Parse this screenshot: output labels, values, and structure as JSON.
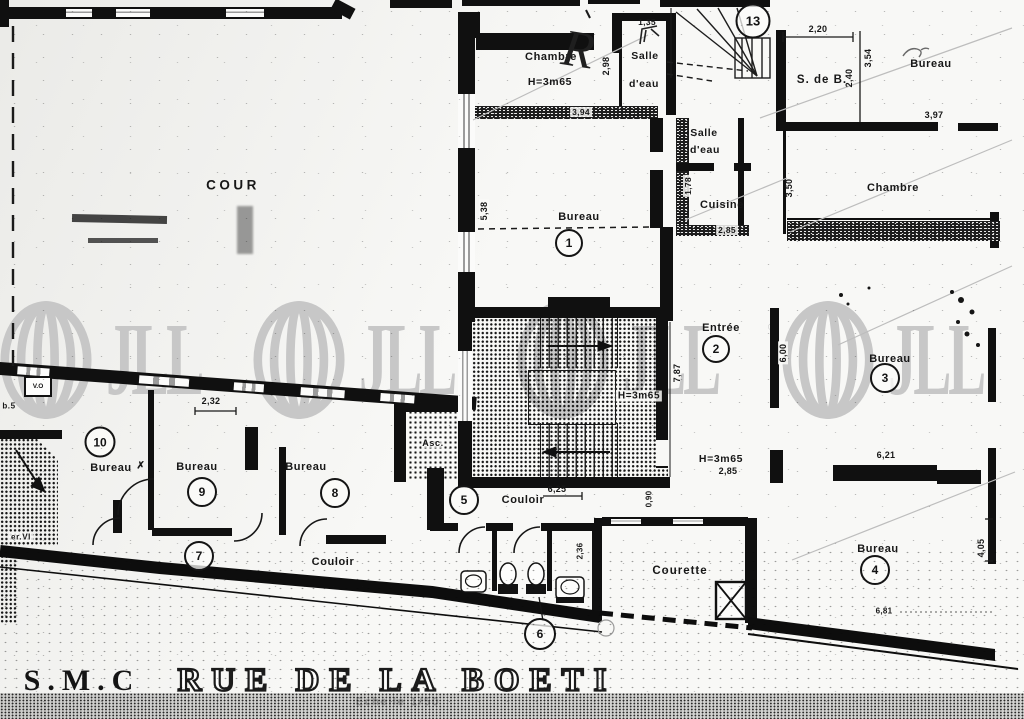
{
  "watermark": {
    "brand": "JLL",
    "registered": "®",
    "color": "#c7c7c7"
  },
  "title_block": {
    "company": "S.M.C",
    "street": "RUE DE LA BOETI",
    "scale_note": "Echelle 1/50"
  },
  "areas": {
    "cour": "COUR",
    "courette": "Courette",
    "couloir_west": "Couloir",
    "couloir_center": "Couloir",
    "cuisine": "Cuisine",
    "salle_eau_upper_1": "Salle",
    "salle_eau_upper_2": "d'eau",
    "salle_eau_mid_1": "Salle",
    "salle_eau_mid_2": "d'eau",
    "s_de_b": "S. de B.",
    "chambre_upper": "Chambre",
    "chambre_east": "Chambre",
    "bureau_ne": "Bureau",
    "asc": "Asc."
  },
  "rooms": {
    "r1": {
      "label": "Bureau",
      "num": "1"
    },
    "r2": {
      "label": "Entrée",
      "num": "2"
    },
    "r3": {
      "label": "Bureau",
      "num": "3"
    },
    "r4": {
      "label": "Bureau",
      "num": "4"
    },
    "r5": {
      "num": "5"
    },
    "r6": {
      "num": "6"
    },
    "r7": {
      "num": "7"
    },
    "r8": {
      "label": "Bureau",
      "num": "8"
    },
    "r9": {
      "label": "Bureau",
      "num": "9"
    },
    "r10": {
      "label": "Bureau",
      "num": "10",
      "mark": "✗"
    },
    "r13": {
      "num": "13"
    }
  },
  "heights": {
    "chambre": "H=3m65",
    "stairwell": "H=3m65",
    "east_wing": "H=3m65",
    "east_wing_sub": "2,85"
  },
  "dims": {
    "d135": "1,35",
    "d298": "2,98",
    "d394": "3,94",
    "d220": "2,20",
    "d240": "2,40",
    "d354": "3,54",
    "d397": "3,97",
    "d350": "3,50",
    "d178": "1,78",
    "d285": "2,85",
    "d538": "5,38",
    "d600": "6,00",
    "d787": "7,87",
    "d625": "6,25",
    "d232": "2,32",
    "d236": "2,36",
    "d621": "6,21",
    "d405": "4,05",
    "d681": "6,81",
    "d090": "0,90"
  },
  "annotations": {
    "hand_mark": "R",
    "vo": "V.O",
    "eb5": "b.5",
    "er_vi": "er.VI"
  }
}
